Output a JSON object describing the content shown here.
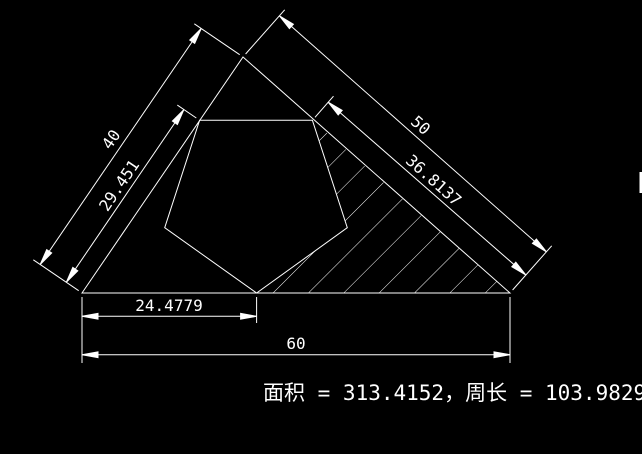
{
  "drawing": {
    "background": "#000000",
    "line_color": "#ffffff",
    "dimensions": {
      "left_outer": "40",
      "left_inner": "29.451",
      "right_outer": "50",
      "right_inner": "36.8137",
      "bottom_inner": "24.4779",
      "bottom_outer": "60"
    },
    "annotation": {
      "area_label": "面积",
      "area_value": "313.4152",
      "perimeter_label": "周长",
      "perimeter_value": "103.9829",
      "full_text": "面积 = 313.4152，周长 = 103.9829"
    }
  }
}
